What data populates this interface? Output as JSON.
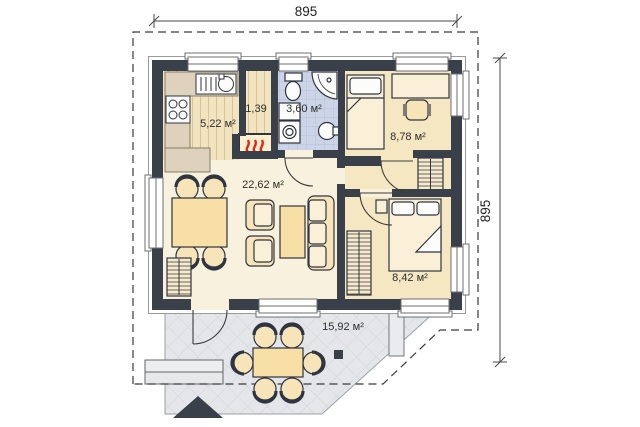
{
  "title": "House floor plan",
  "dimensions": {
    "top": "895",
    "right": "895"
  },
  "rooms": {
    "kitchen": {
      "area": "5,22 м²"
    },
    "boiler": {
      "area": "1,39"
    },
    "bathroom": {
      "area": "3,60 м²"
    },
    "bedroom_top": {
      "area": "8,78 м²"
    },
    "living": {
      "area": "22,62 м²"
    },
    "bedroom_bottom": {
      "area": "8,42 м²"
    },
    "terrace": {
      "area": "15,92 м²"
    }
  },
  "icons": [
    "kitchen-sink-icon",
    "stove-icon",
    "heater-icon",
    "toilet-icon",
    "shower-icon",
    "washer-icon",
    "bath-sink-icon",
    "single-bed-icon",
    "double-bed-icon",
    "desk-icon",
    "chair-icon",
    "wardrobe-icon",
    "dining-table-icon",
    "armchair-icon",
    "sofa-icon",
    "coffee-table-icon",
    "terrace-table-icon",
    "entrance-marker-icon"
  ],
  "colors": {
    "wall": "#3a4049",
    "floor_cream": "#f8f1dd",
    "floor_tan": "#f6e7c3",
    "floor_wood": "#f2e4bf",
    "bath_tile": "#ccd4e7",
    "terrace": "#e4e6e9",
    "furniture": "#f7e4b8",
    "counter": "#ded2bd",
    "flame": "#e02818"
  }
}
